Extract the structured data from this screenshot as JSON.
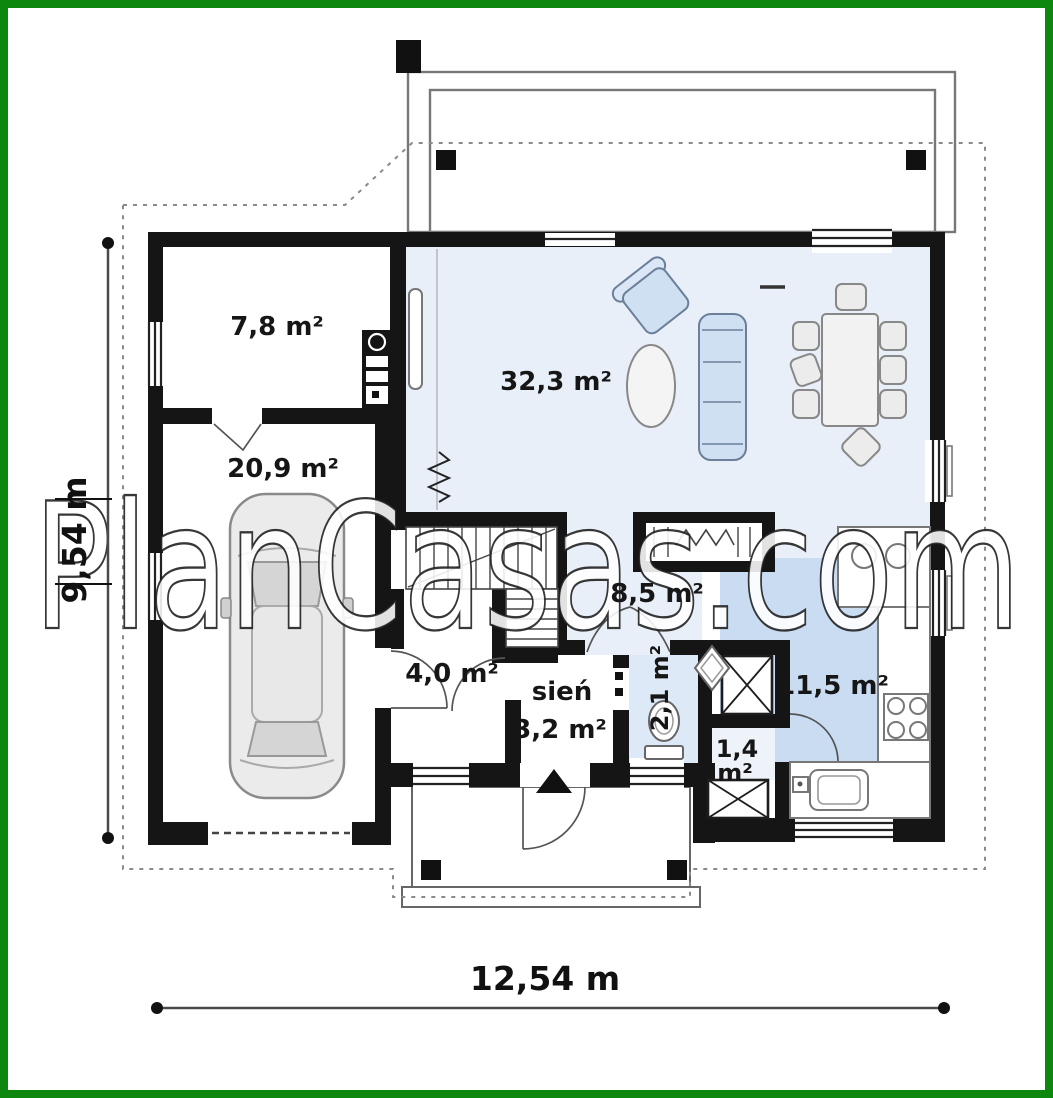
{
  "frame": {
    "border_color": "#0e870e",
    "background": "#ffffff"
  },
  "watermark": {
    "text": "PlanCasas.com"
  },
  "dimensions": {
    "width_label": "12,54 m",
    "height_label": "9,54 m"
  },
  "rooms": {
    "utility": {
      "area": "7,8 m²"
    },
    "garage": {
      "area": "20,9 m²"
    },
    "living": {
      "area": "32,3 m²"
    },
    "hall": {
      "area": "8,5 m²"
    },
    "mudroom": {
      "area": "4,0 m²"
    },
    "vestibule": {
      "name": "sień",
      "area": "3,2 m²"
    },
    "wc": {
      "area": "2,1 m²"
    },
    "pantry": {
      "value": "1,4",
      "unit": "m²"
    },
    "kitchen": {
      "area": "11,5 m²"
    }
  },
  "palette": {
    "wall": "#151515",
    "floor_tint": "#e9eff8",
    "rug_tint": "#c9dcf2",
    "furniture_tint": "#cfe0f3",
    "plan_line": "#777777",
    "watermark_fill": "#ffffff",
    "watermark_outline": "#1b1b1b"
  }
}
